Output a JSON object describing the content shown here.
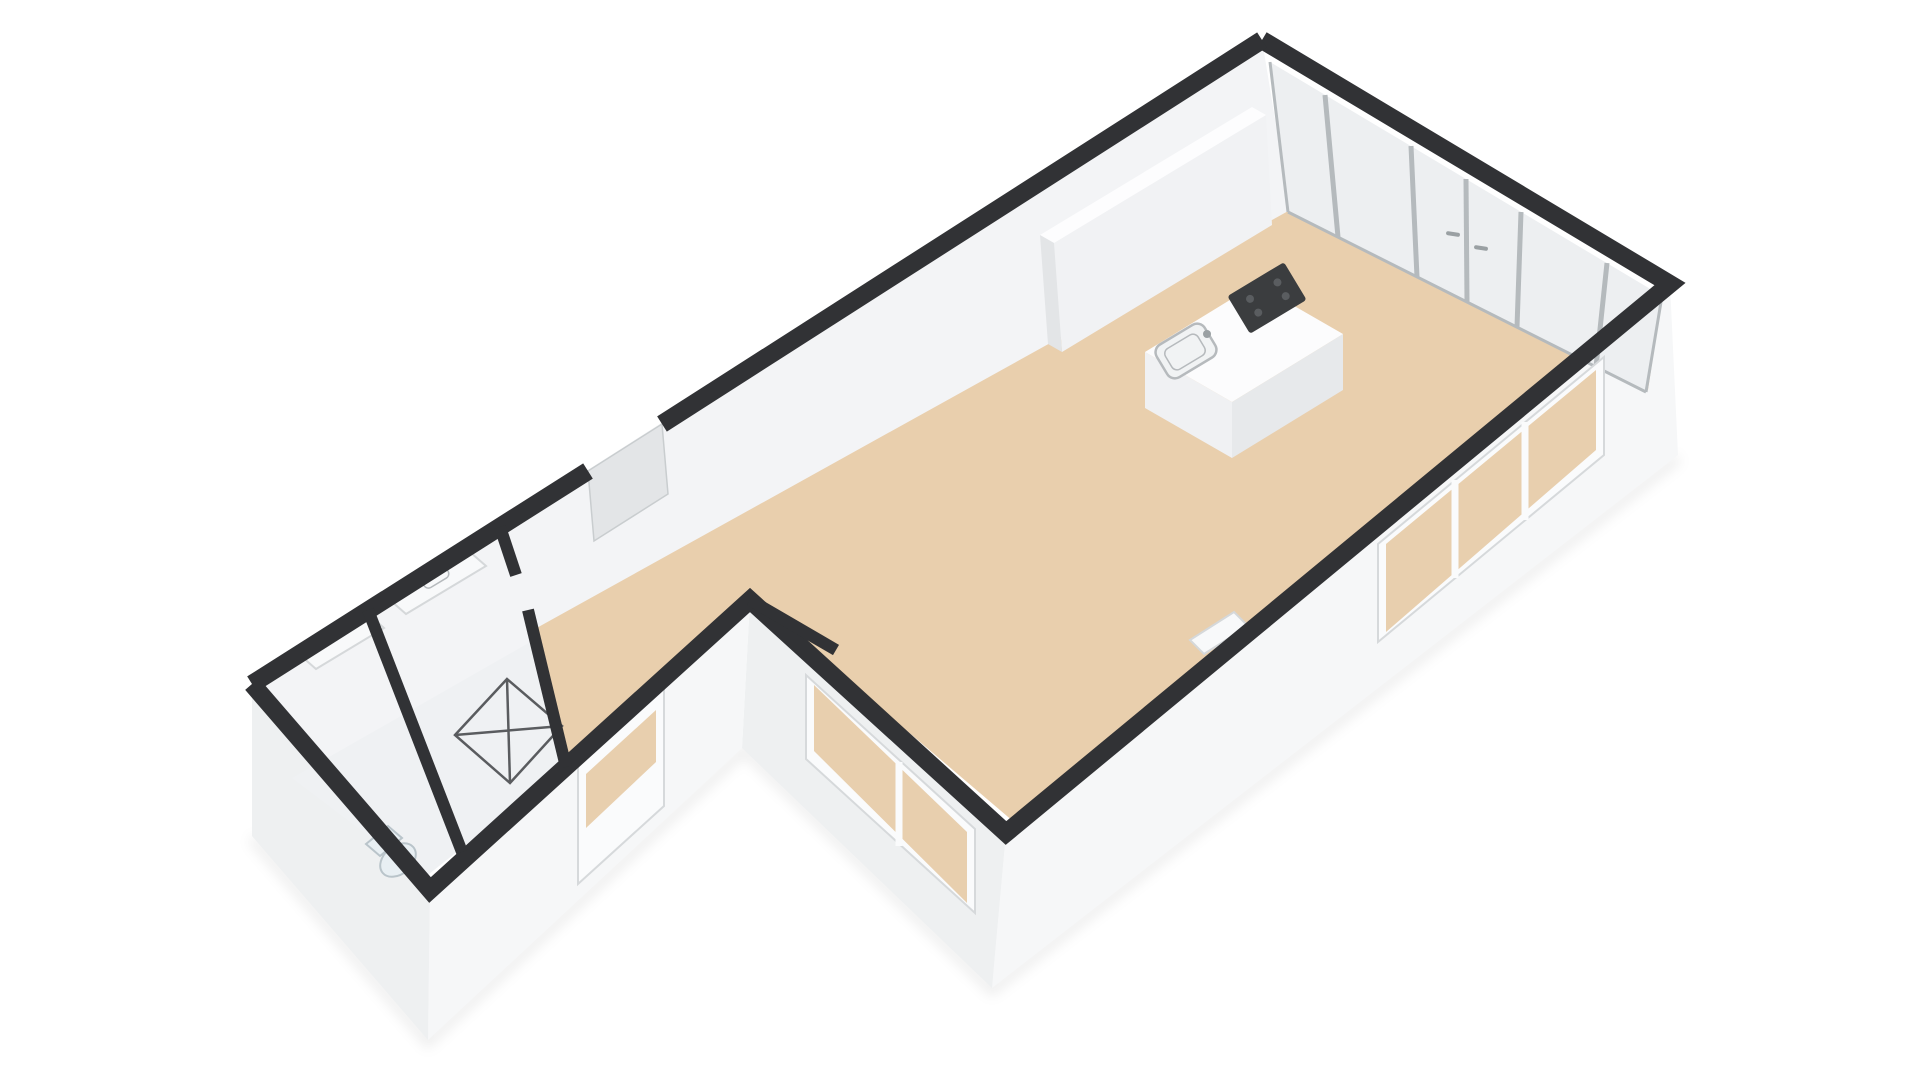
{
  "scene": {
    "type": "3d-floorplan-render",
    "rooms": [
      "living-kitchen-open-space",
      "entry-hall",
      "bathroom",
      "toilet-room"
    ],
    "fixtures": [
      "kitchen-island",
      "induction-cooktop",
      "kitchen-sink",
      "shower-tray",
      "toilet",
      "vanity-cabinet",
      "storage-cabinet",
      "radiator",
      "glazed-end-wall",
      "french-door-handles",
      "side-window-run",
      "bay-window",
      "glazed-front-door",
      "side-door-opening"
    ]
  },
  "colors": {
    "background": "#ffffff",
    "wall_top": "#313235",
    "wall_face": "#f6f7f8",
    "wall_face_shaded": "#eef0f1",
    "wall_face_dark": "#e3e5e7",
    "wall_inner": "#f3f4f6",
    "floor_main": "#e9cfad",
    "floor_wet": "#eff1f3",
    "glass": "#edeff1",
    "glass_frame": "#b5babd",
    "window_frame": "#fafbfc",
    "through_glass": "#e8cfae",
    "island_top": "#fcfcfd",
    "island_side": "#f0f1f3",
    "island_side_dark": "#e7e9eb",
    "cooktop": "#3b3d3f",
    "fixture_line": "#5a5c5f",
    "toilet_fill": "#e8eff3"
  }
}
